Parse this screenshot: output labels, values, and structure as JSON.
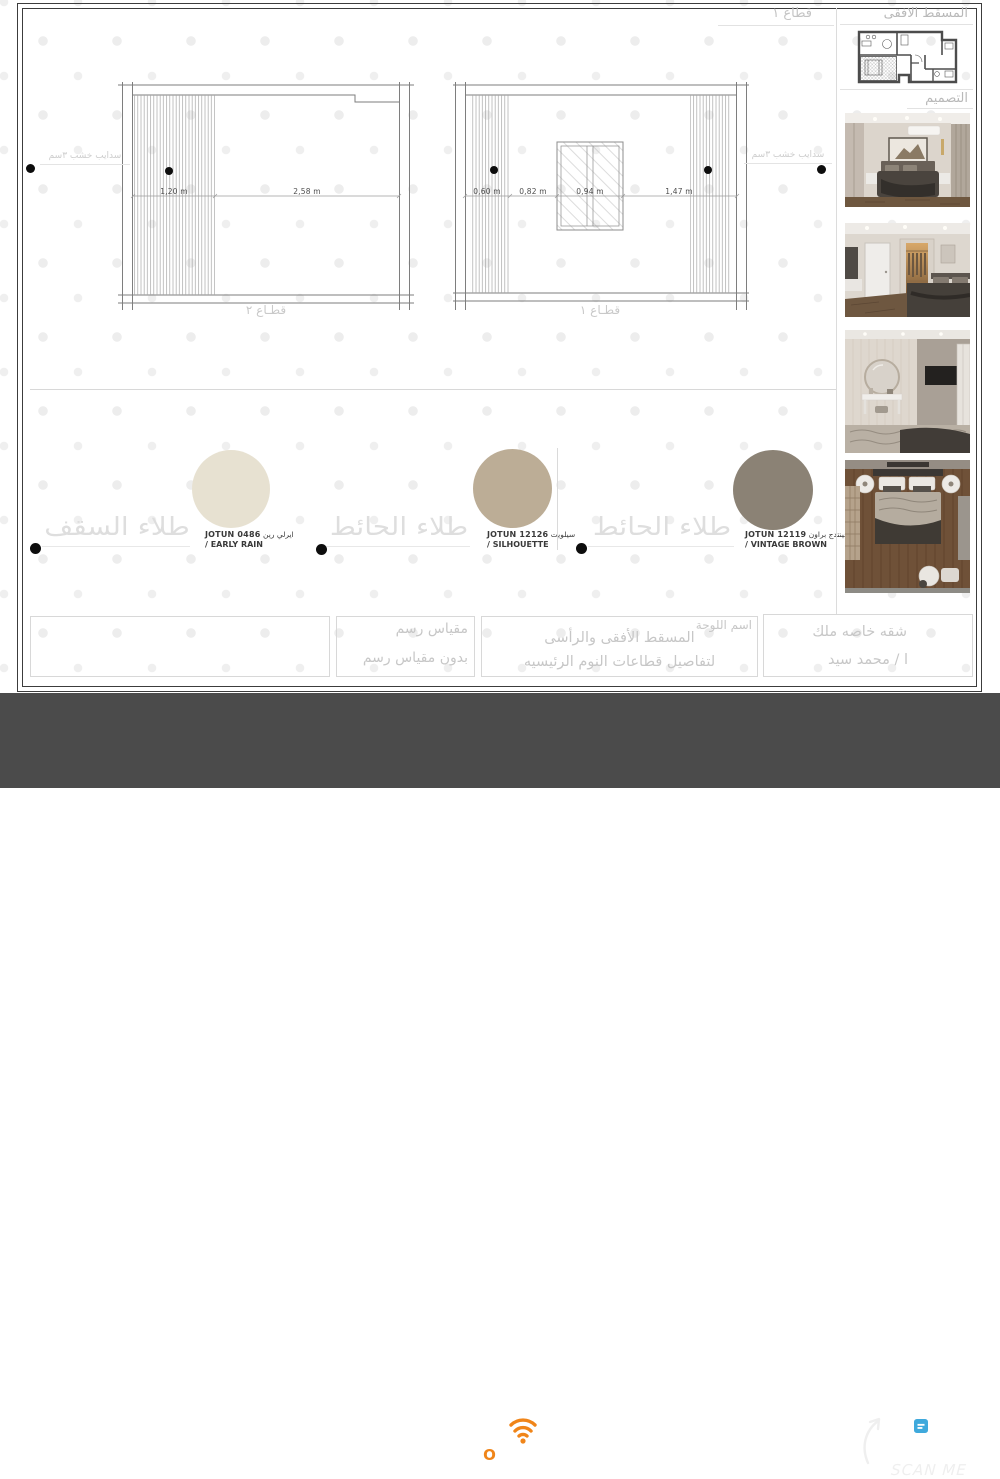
{
  "page": {
    "corner_label": "قطاع ١"
  },
  "sidebar": {
    "plan_heading": "المسقط الافقى",
    "design_heading": "التصميم"
  },
  "drawings": {
    "section_2": {
      "caption": "قطـاع ٢",
      "dims": [
        "1,20 m",
        "2,58 m"
      ]
    },
    "section_1": {
      "caption": "قطـاع ١",
      "dims": [
        "0,60 m",
        "0,82 m",
        "0,94 m",
        "1,47 m"
      ]
    },
    "annotation_left": "سدايب خشب ٣سم",
    "annotation_right": "سدايب خشب ٣سم"
  },
  "swatches": [
    {
      "label_ar": "طلاء السقف",
      "brand_code": "JOTUN 0486",
      "name_ar": "ايرلي رين",
      "name_en": "/ EARLY RAIN",
      "color": "#e7e1d1"
    },
    {
      "label_ar": "طلاء الحائط",
      "brand_code": "JOTUN 12126",
      "name_ar": "سيلويت",
      "name_en": "/ SILHOUETTE",
      "color": "#bcad96"
    },
    {
      "label_ar": "طلاء الحائط",
      "brand_code": "JOTUN 12119",
      "name_ar": "فينتدج براون",
      "name_en": "/ VINTAGE BROWN",
      "color": "#8b8275"
    }
  ],
  "titleblock": {
    "scale_label": "مقياس رسم",
    "scale_value": "بدون مقياس رسم",
    "sheet_name_label": "اسم اللوحة",
    "sheet_title_line1": "المسقط الأفقى والرأسى",
    "sheet_title_line2": "لتفاصيل قطاعات النوم الرئيسيه",
    "project_line1": "شقه خاصه ملك",
    "project_line2": "ا / محمد سيد"
  },
  "footer": {
    "brand": "MOULLAK",
    "brand_parts": [
      "M",
      "O",
      "ULLAK"
    ],
    "scan_label": "SCAN ME",
    "accent_color": "#f08519",
    "bar_color": "#4b4b4b",
    "qr_icon_color": "#3fa9dc"
  }
}
